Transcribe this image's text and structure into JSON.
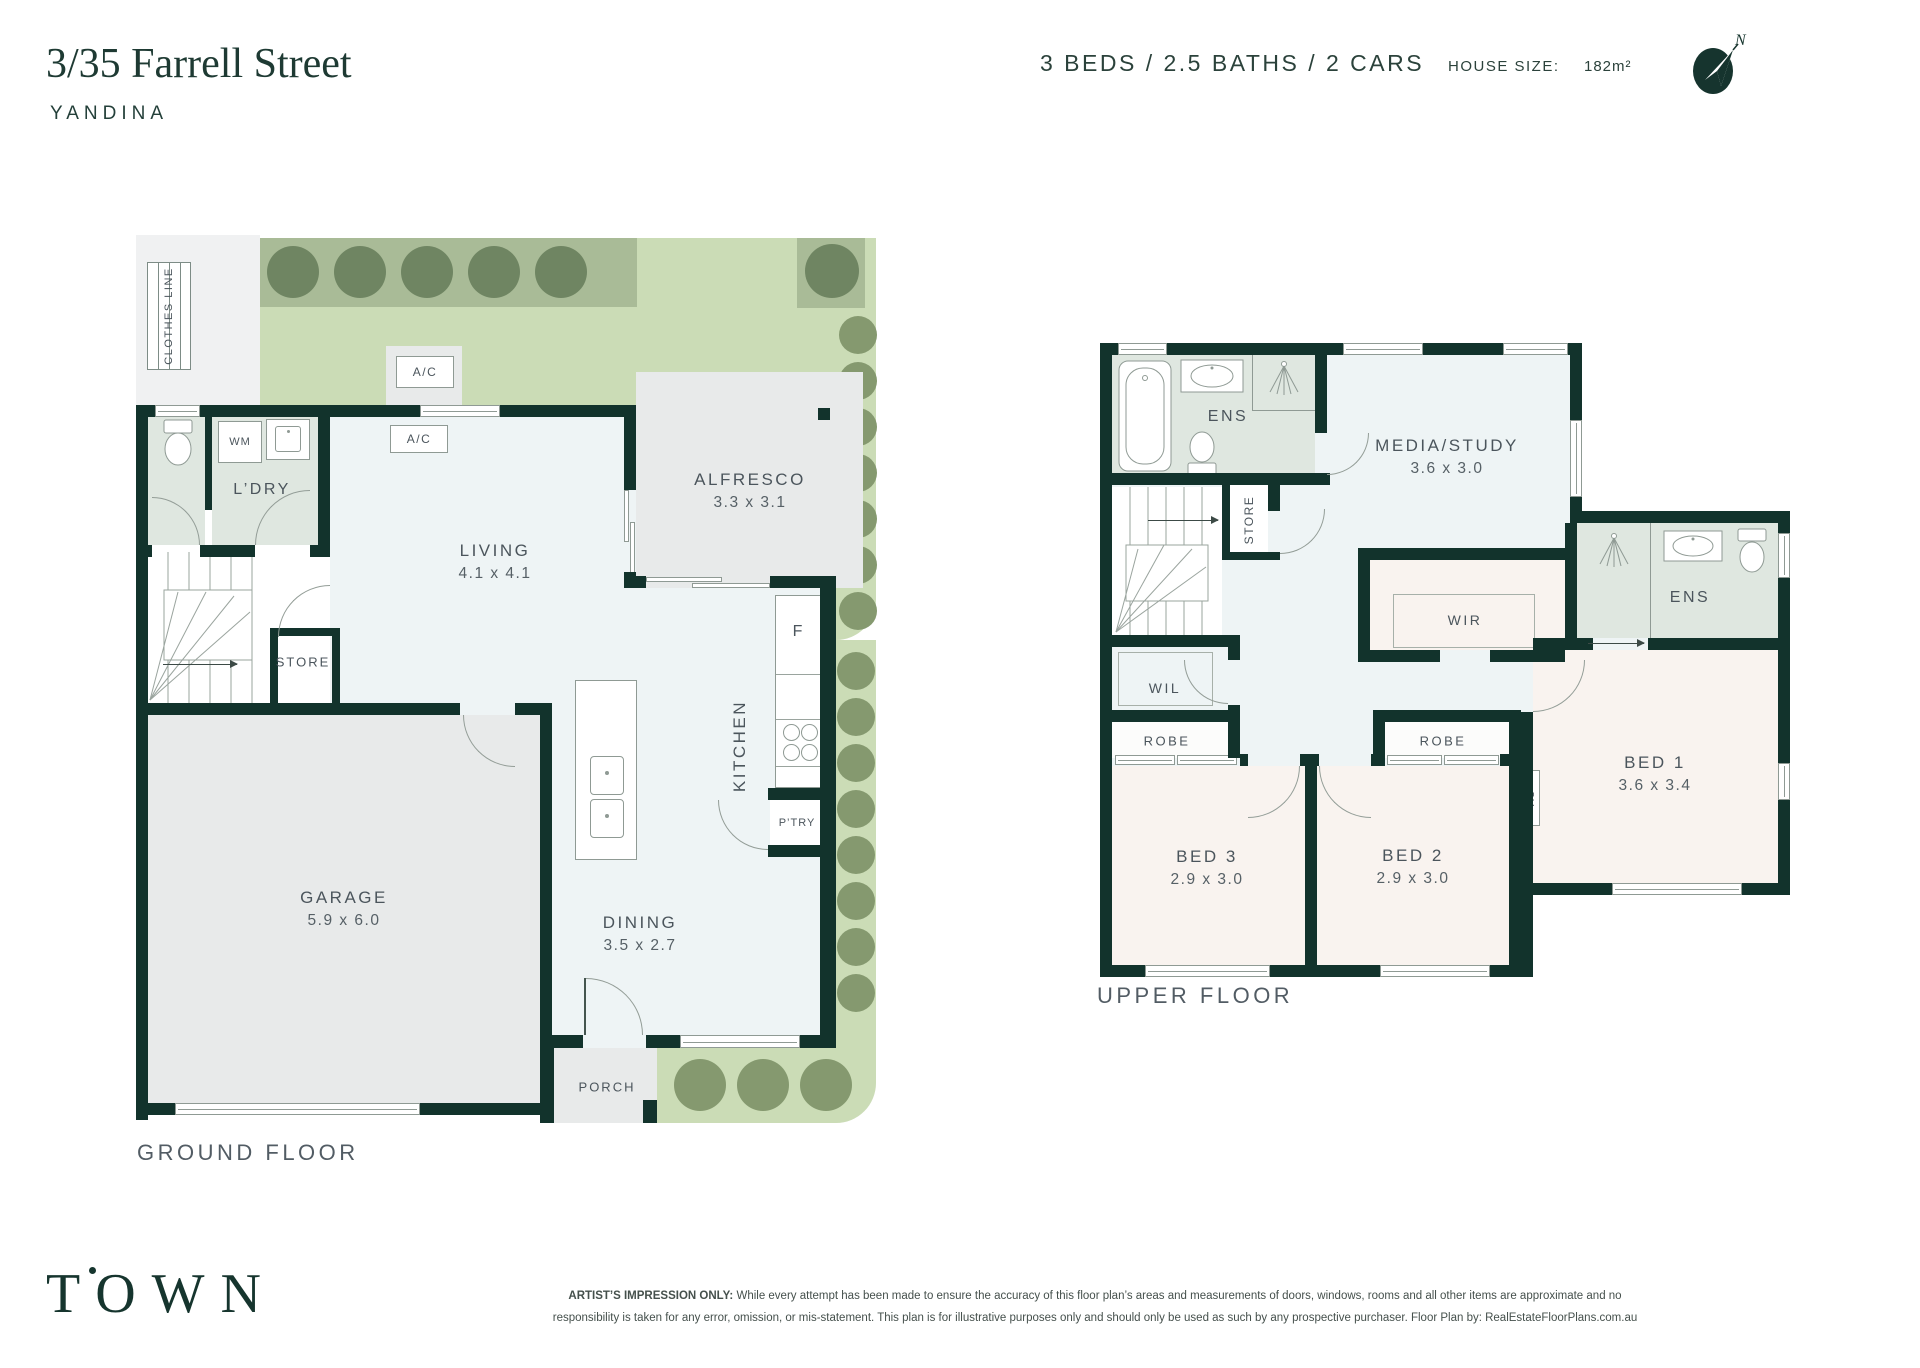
{
  "header": {
    "address": "3/35 Farrell Street",
    "suburb": "YANDINA",
    "bed_bath_car": "3 BEDS  /  2.5 BATHS  /  2 CARS",
    "house_size_label": "HOUSE SIZE:",
    "house_size_value": "182m²",
    "compass_north": "N"
  },
  "colors": {
    "brand_dark_green": "#16352e",
    "wall": "#12332c",
    "garden_light": "#cbdcb6",
    "garden_dark": "#a9bb97",
    "bathroom_sage": "#dfe7e0",
    "interior_blue": "#eef4f5",
    "bedroom_warm": "#f9f3ef",
    "hard_surface_grey": "#e8eaea"
  },
  "ground_floor": {
    "caption": "GROUND FLOOR",
    "clothes_line_label": "CLOTHES LINE",
    "living": {
      "name": "LIVING",
      "dims": "4.1 x 4.1"
    },
    "alfresco": {
      "name": "ALFRESCO",
      "dims": "3.3 x 3.1"
    },
    "garage": {
      "name": "GARAGE",
      "dims": "5.9 x 6.0"
    },
    "dining": {
      "name": "DINING",
      "dims": "3.5 x 2.7"
    },
    "kitchen_label": "KITCHEN",
    "laundry_label": "L’DRY",
    "store_label": "STORE",
    "pantry_label": "P’TRY",
    "porch_label": "PORCH",
    "fridge_label": "F",
    "wm_label": "WM",
    "ac_outdoor_label": "A/C",
    "ac_indoor_label": "A/C"
  },
  "upper_floor": {
    "caption": "UPPER FLOOR",
    "media": {
      "name": "MEDIA/STUDY",
      "dims": "3.6 x 3.0"
    },
    "bed1": {
      "name": "BED 1",
      "dims": "3.6 x 3.4"
    },
    "bed2": {
      "name": "BED 2",
      "dims": "2.9 x 3.0"
    },
    "bed3": {
      "name": "BED 3",
      "dims": "2.9 x 3.0"
    },
    "ens1_label": "ENS",
    "ens2_label": "ENS",
    "wir_label": "WIR",
    "wil_label": "WIL",
    "store_label": "STORE",
    "robe1_label": "ROBE",
    "robe2_label": "ROBE",
    "ac_label": "AC"
  },
  "footer": {
    "logo": "TOWN",
    "disclaimer_lead": "ARTIST’S IMPRESSION ONLY:",
    "disclaimer_line1": " While every attempt has been made to ensure the accuracy of this floor plan’s areas and measurements of doors, windows, rooms and all other items are approximate and no",
    "disclaimer_line2": "responsibility is taken for any error, omission, or mis-statement. This plan is for illustrative purposes only and should only be used as such by any prospective purchaser. Floor Plan by: RealEstateFloorPlans.com.au"
  }
}
